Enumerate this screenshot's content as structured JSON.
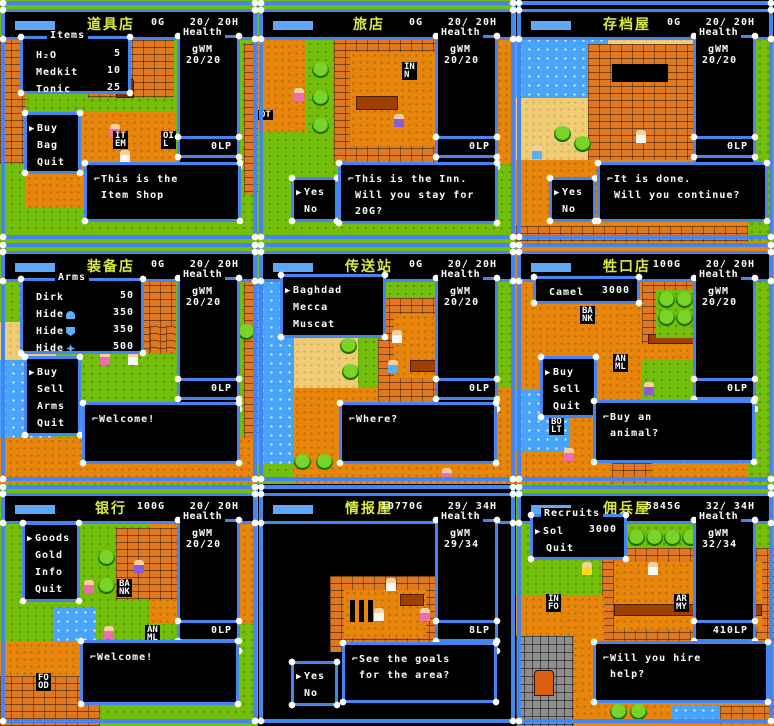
{
  "ui": {
    "health_label": "Health",
    "player_tag": "gWM",
    "cursor": "▶"
  },
  "panels": [
    {
      "name": "item-shop",
      "title": "道具店",
      "gold": "0G",
      "hp": "20/ 20H",
      "hp_value": "20/20",
      "lp": "0LP",
      "list_label": "Items",
      "list": [
        {
          "name": "H₂O",
          "value": "5"
        },
        {
          "name": "Medkit",
          "value": "10"
        },
        {
          "name": "Tonic",
          "value": "25"
        }
      ],
      "menu": [
        "Buy",
        "Bag",
        "Quit"
      ],
      "dialog": [
        "⌐This is the",
        " Item Shop"
      ],
      "signs": {
        "s1a": "IT",
        "s1b": "EM",
        "s2a": "OI",
        "s2b": "L"
      }
    },
    {
      "name": "inn",
      "title": "旅店",
      "gold": "0G",
      "hp": "20/ 20H",
      "hp_value": "20/20",
      "lp": "0LP",
      "yesno": [
        "Yes",
        "No"
      ],
      "dialog": [
        "⌐This is the Inn.",
        " Will you stay for",
        " 20G?"
      ],
      "signs": {
        "s1a": "IN",
        "s1b": "N",
        "s2a": "OT"
      }
    },
    {
      "name": "save-house",
      "title": "存档屋",
      "gold": "0G",
      "hp": "20/ 20H",
      "hp_value": "20/20",
      "lp": "0LP",
      "yesno": [
        "Yes",
        "No"
      ],
      "dialog": [
        "⌐It is done.",
        " Will you continue?"
      ]
    },
    {
      "name": "arms-shop",
      "title": "装备店",
      "gold": "0G",
      "hp": "20/ 20H",
      "hp_value": "20/20",
      "lp": "0LP",
      "list_label": "Arms",
      "list": [
        {
          "name": "Dirk",
          "value": "50",
          "icon": ""
        },
        {
          "name": "Hide",
          "value": "350",
          "icon": "helmet-icon"
        },
        {
          "name": "Hide",
          "value": "350",
          "icon": "shield-icon"
        },
        {
          "name": "Hide",
          "value": "500",
          "icon": "armor-icon"
        }
      ],
      "menu": [
        "Buy",
        "Sell",
        "Arms",
        "Quit"
      ],
      "dialog": [
        "⌐Welcome!"
      ]
    },
    {
      "name": "teleport-station",
      "title": "传送站",
      "gold": "0G",
      "hp": "20/ 20H",
      "hp_value": "20/20",
      "lp": "0LP",
      "destinations": [
        "Baghdad",
        "Mecca",
        "Muscat"
      ],
      "dialog": [
        "⌐Where?"
      ]
    },
    {
      "name": "animal-shop",
      "title": "牲口店",
      "gold": "100G",
      "hp": "20/ 20H",
      "hp_value": "20/20",
      "lp": "0LP",
      "list": [
        {
          "name": "Camel",
          "value": "3000"
        }
      ],
      "menu": [
        "Buy",
        "Sell",
        "Quit"
      ],
      "dialog": [
        "⌐Buy an",
        " animal?"
      ],
      "signs": {
        "s1a": "BA",
        "s1b": "NK",
        "s2a": "AN",
        "s2b": "ML",
        "s3a": "BO",
        "s3b": "LT"
      }
    },
    {
      "name": "bank",
      "title": "银行",
      "gold": "100G",
      "hp": "20/ 20H",
      "hp_value": "20/20",
      "lp": "0LP",
      "menu": [
        "Goods",
        "Gold",
        "Info",
        "Quit"
      ],
      "dialog": [
        "⌐Welcome!"
      ],
      "signs": {
        "s1a": "BA",
        "s1b": "NK",
        "s2a": "AN",
        "s2b": "ML",
        "s3a": "FO",
        "s3b": "OD"
      }
    },
    {
      "name": "info-house",
      "title": "情报屋",
      "gold": "10770G",
      "hp": "29/ 34H",
      "hp_value": "29/34",
      "lp": "8LP",
      "yesno": [
        "Yes",
        "No"
      ],
      "dialog": [
        "⌐See the goals",
        " for the area?"
      ]
    },
    {
      "name": "recruit-house",
      "title": "佣兵屋",
      "gold": "5845G",
      "hp": "32/ 34H",
      "hp_value": "32/34",
      "lp": "410LP",
      "list_label": "Recruits",
      "list": [
        {
          "name": "Sol",
          "value": "3000"
        },
        {
          "name": "Quit",
          "value": ""
        }
      ],
      "dialog": [
        "⌐Will you hire",
        " help?"
      ],
      "signs": {
        "s1a": "IN",
        "s1b": "FO",
        "s2a": "AR",
        "s2b": "MY"
      }
    }
  ]
}
